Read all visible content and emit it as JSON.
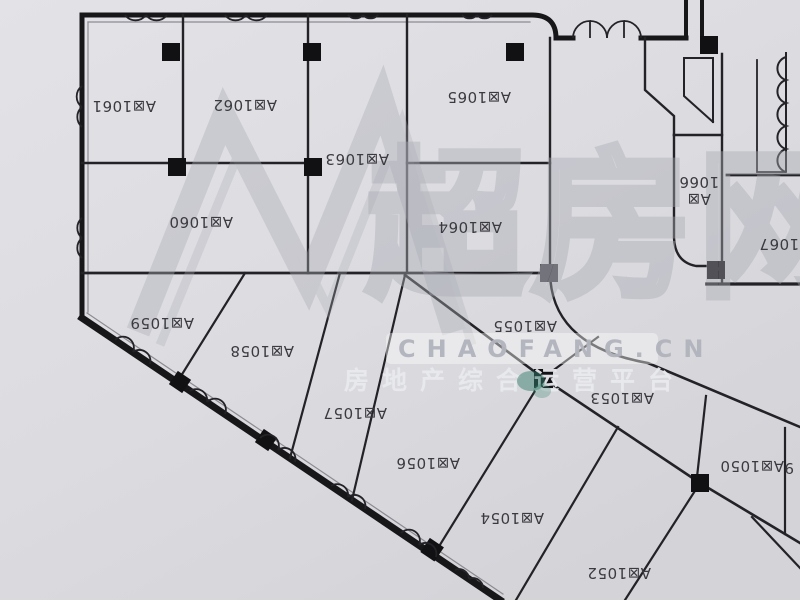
{
  "plan": {
    "area_prefix": "A区",
    "labels_rotated_degrees": 180,
    "units": [
      {
        "id": "1061",
        "label": "A区1061",
        "x": 124,
        "y": 101
      },
      {
        "id": "1062",
        "label": "A区1062",
        "x": 245,
        "y": 100
      },
      {
        "id": "1063",
        "label": "A区1063",
        "x": 357,
        "y": 154
      },
      {
        "id": "1065",
        "label": "A区1065",
        "x": 479,
        "y": 92
      },
      {
        "id": "1064",
        "label": "A区1064",
        "x": 470,
        "y": 222
      },
      {
        "id": "1060",
        "label": "A区1060",
        "x": 201,
        "y": 217
      },
      {
        "id": "1066",
        "label": "A区1066",
        "x": 699,
        "y": 192,
        "lines": [
          "A区",
          "1066"
        ]
      },
      {
        "id": "1067",
        "label": "A区1067",
        "x": 791,
        "y": 239
      },
      {
        "id": "1059",
        "label": "A区1059",
        "x": 162,
        "y": 318
      },
      {
        "id": "1058",
        "label": "A区1058",
        "x": 262,
        "y": 346
      },
      {
        "id": "1057",
        "label": "A区1057",
        "x": 355,
        "y": 408
      },
      {
        "id": "1056",
        "label": "A区1056",
        "x": 428,
        "y": 458
      },
      {
        "id": "1055",
        "label": "A区1055",
        "x": 525,
        "y": 321
      },
      {
        "id": "1054",
        "label": "A区1054",
        "x": 512,
        "y": 513
      },
      {
        "id": "1053",
        "label": "A区1053",
        "x": 622,
        "y": 393
      },
      {
        "id": "1052",
        "label": "A区1052",
        "x": 619,
        "y": 568
      },
      {
        "id": "1050",
        "label": "A区1050",
        "x": 752,
        "y": 461
      }
    ],
    "partial_unit": {
      "text": "9",
      "x": 794,
      "y": 463
    },
    "colors": {
      "wall": "#1c1c1e",
      "label": "#3a3a40",
      "paper": "#dcdce0"
    }
  },
  "watermark": {
    "brand": "超房网",
    "domain": "CHAOFANG.CN",
    "tagline": "房地产综合运营平台",
    "color": "#aeb0b8",
    "accent_blob_color": "#37806e"
  }
}
